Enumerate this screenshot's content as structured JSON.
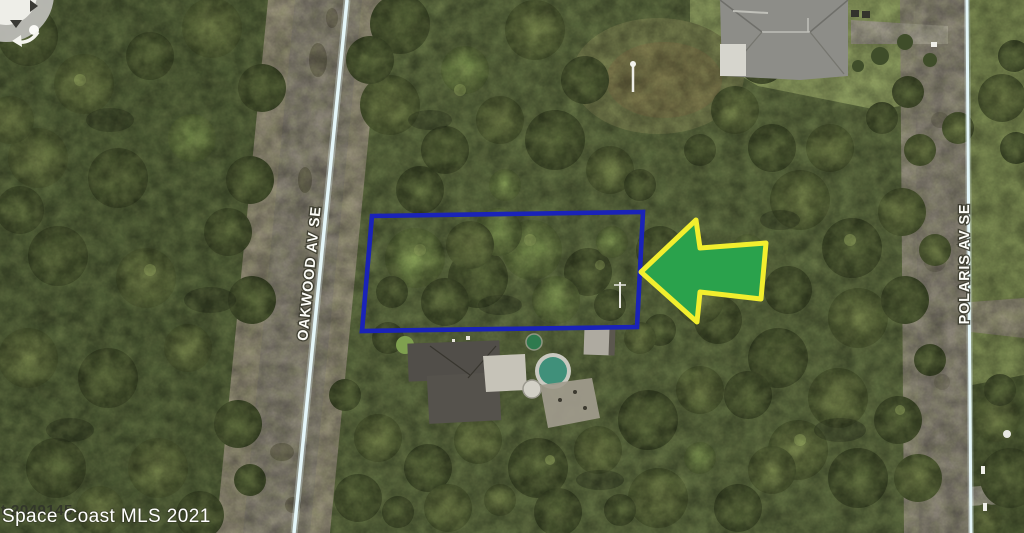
{
  "streets": {
    "left_label": "OAKWOOD AV SE",
    "right_label": "POLARIS AV SE"
  },
  "watermark": {
    "text": "Space Coast MLS 2021",
    "underlay_text": "st 2049145"
  },
  "colors": {
    "lot_outline": "#1a23b8",
    "arrow_fill": "#2aa24c",
    "arrow_border": "#f2ee2e",
    "road_line": "#e4f6f9"
  }
}
